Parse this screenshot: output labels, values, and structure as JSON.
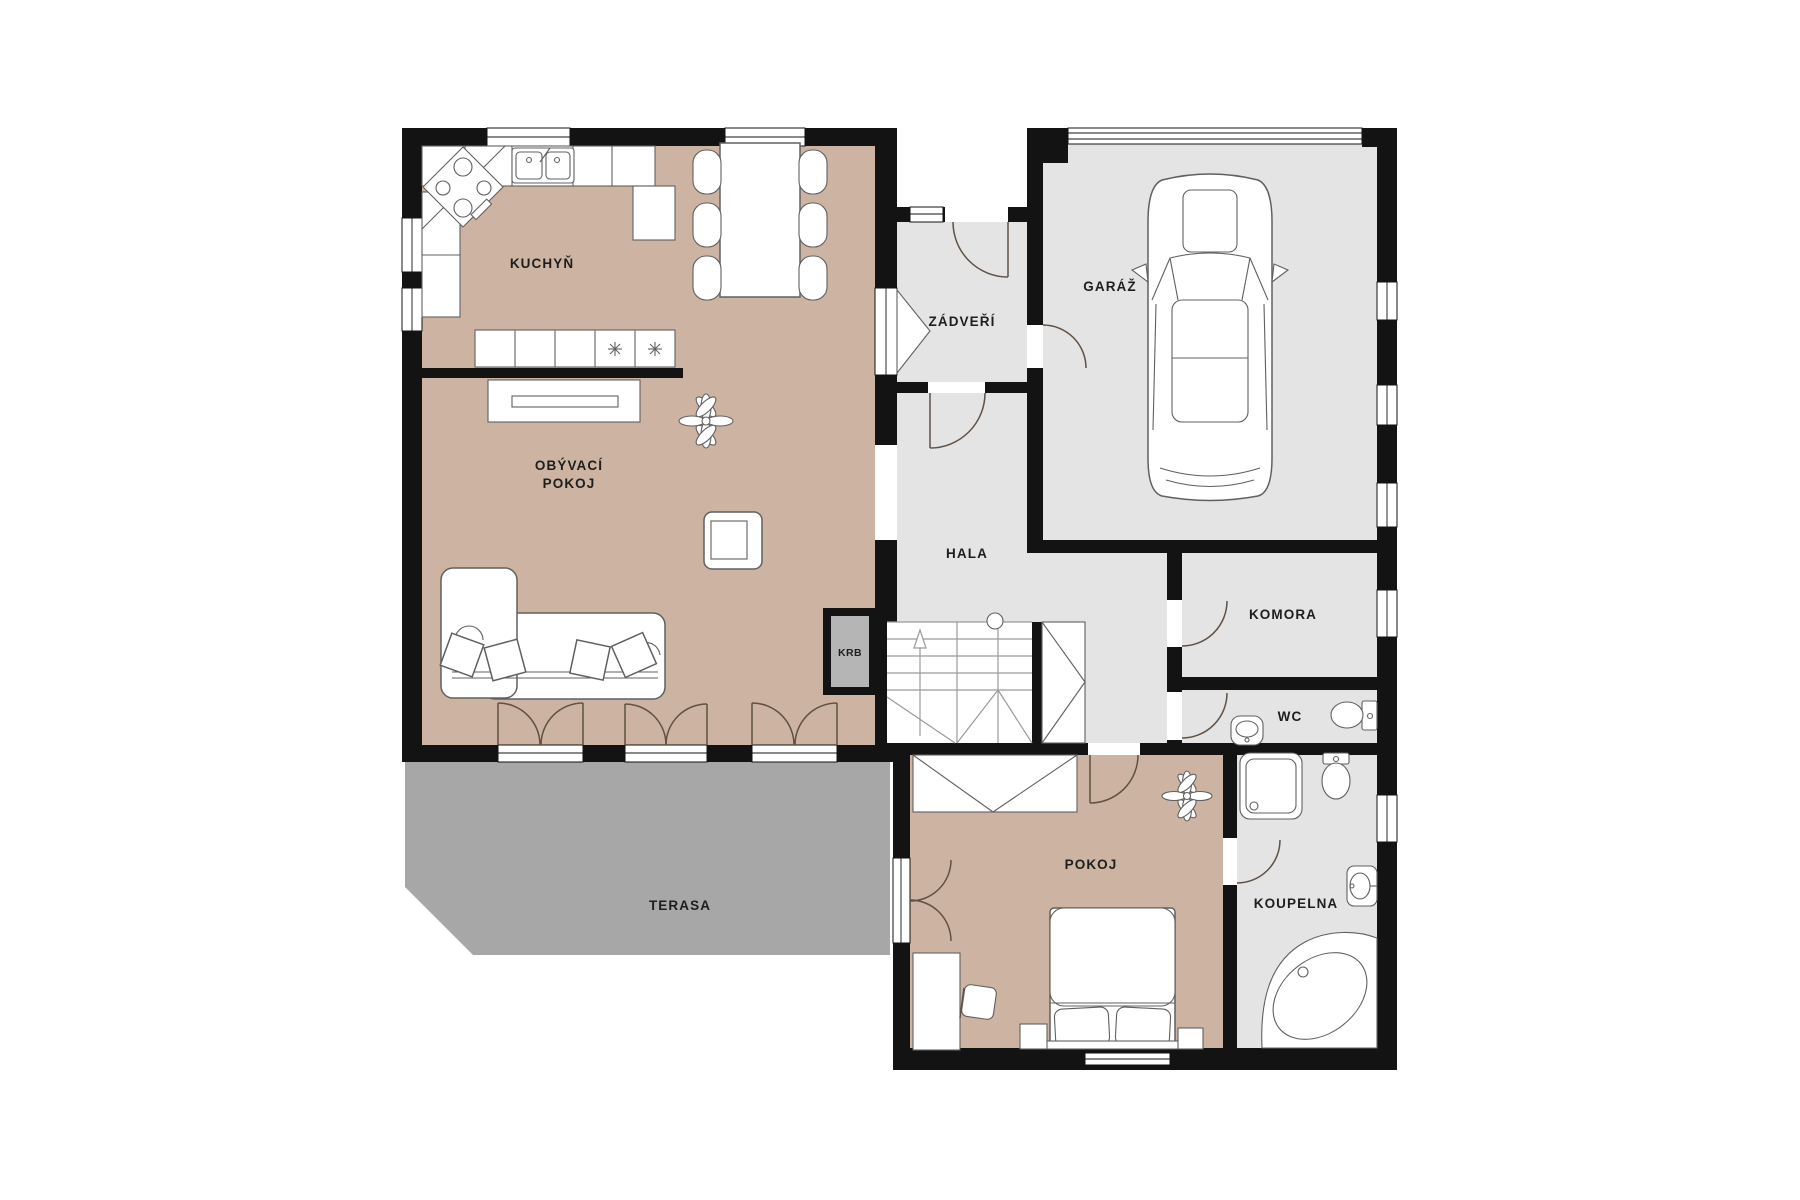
{
  "plan": {
    "type": "floor-plan",
    "colors": {
      "room_floor_beige": "#CDB4A2",
      "room_floor_gray": "#E4E4E4",
      "terrace_gray": "#A7A7A7",
      "wall_black": "#131313",
      "fireplace_fill": "#B5B5B5",
      "furniture_stroke": "#606060",
      "door_arc": "#5F5143",
      "background": "#FFFFFF"
    },
    "rooms": {
      "kuchyn": {
        "label": "KUCHYŇ"
      },
      "obyvaci": {
        "label_line1": "OBÝVACÍ",
        "label_line2": "POKOJ"
      },
      "zadveri": {
        "label": "ZÁDVEŘÍ"
      },
      "garaz": {
        "label": "GARÁŽ"
      },
      "hala": {
        "label": "HALA"
      },
      "komora": {
        "label": "KOMORA"
      },
      "wc": {
        "label": "WC"
      },
      "krb": {
        "label": "KRB"
      },
      "terasa": {
        "label": "TERASA"
      },
      "pokoj": {
        "label": "POKOJ"
      },
      "koupelna": {
        "label": "KOUPELNA"
      }
    },
    "furniture_icons": [
      "stove-icon",
      "double-sink-icon",
      "kitchen-counter-icon",
      "dining-table-icon",
      "chair-icon",
      "tv-sideboard-icon",
      "plant-icon",
      "armchair-icon",
      "corner-sofa-icon",
      "pillow-icon",
      "fireplace-icon",
      "stairs-icon",
      "wardrobe-icon",
      "car-icon",
      "bed-icon",
      "desk-icon",
      "nightstand-icon",
      "shower-icon",
      "toilet-icon",
      "washbasin-icon",
      "corner-bathtub-icon",
      "door-swing-icon",
      "window-icon",
      "entrance-door-icon"
    ]
  }
}
